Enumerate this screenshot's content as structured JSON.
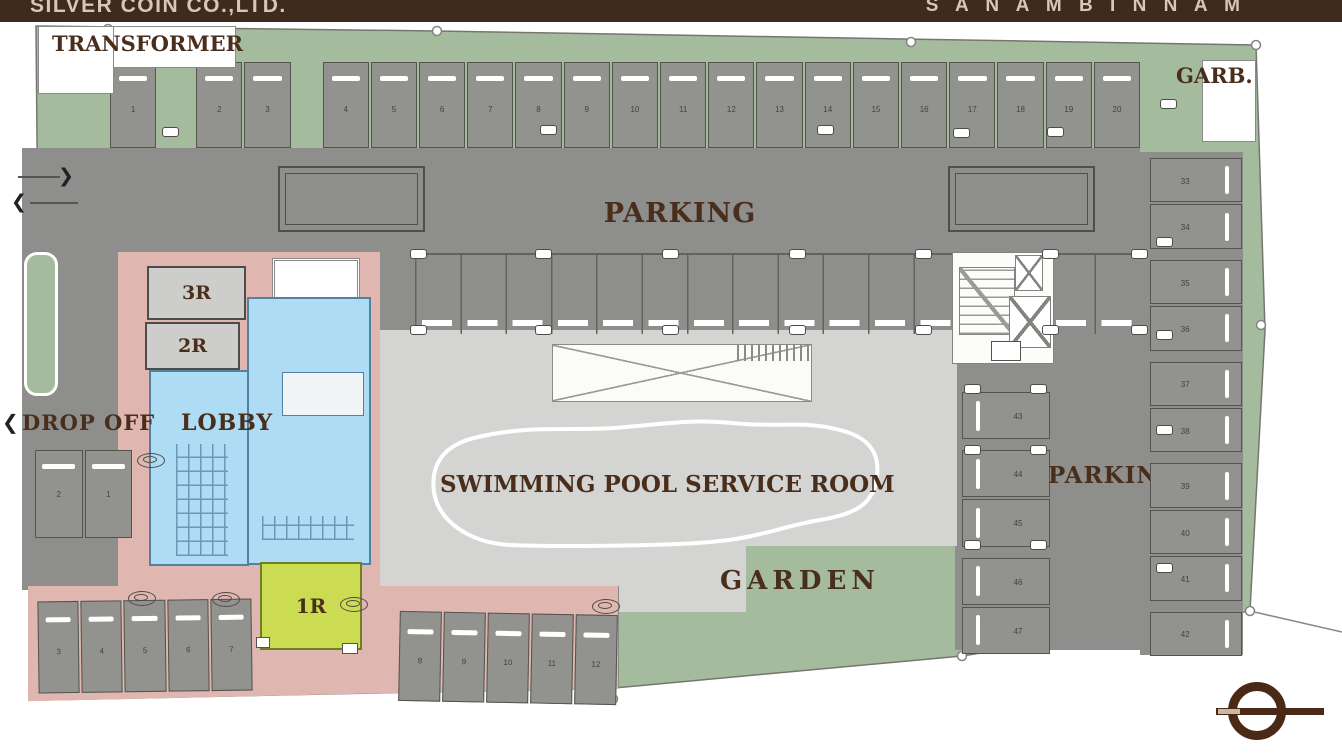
{
  "header": {
    "company": "SILVER COIN CO.,LTD.",
    "project": "S A N A M B I N N A M"
  },
  "labels": {
    "transformer": "TRANSFORMER",
    "garbage": "GARB.",
    "parking_center": "PARKING",
    "parking_right": "PARKING",
    "garden": "GARDEN",
    "pool_service": "SWIMMING POOL SERVICE ROOM",
    "drop_off": "DROP OFF",
    "lobby": "LOBBY",
    "room_3r": "3R",
    "room_2r": "2R",
    "room_1r": "1R"
  },
  "parking_stalls": {
    "top_row": [
      "1",
      "2",
      "3",
      "4",
      "5",
      "6",
      "7",
      "8",
      "9",
      "10",
      "11",
      "12",
      "13",
      "14",
      "15",
      "16",
      "17",
      "18",
      "19",
      "20"
    ],
    "right_column": [
      "33",
      "34",
      "35",
      "36",
      "37",
      "38",
      "39",
      "40",
      "41",
      "42"
    ],
    "inner_column": [
      "43",
      "44",
      "45",
      "46",
      "47"
    ],
    "bottom_left_row": [
      "3",
      "4",
      "5",
      "6",
      "7"
    ],
    "bottom_middle_row": [
      "8",
      "9",
      "10",
      "11",
      "12"
    ],
    "drop_off_stalls": [
      "2",
      "1"
    ]
  },
  "icons": {
    "arrow_left": "❮",
    "arrow_right": "❯"
  },
  "colors": {
    "banner_brown": "#3F2A1E",
    "site_green": "#A5BB9D",
    "paving_gray": "#8E8E8C",
    "slab_gray": "#D4D4D2",
    "driveway_pink": "#E0B6B0",
    "building_blue": "#AEDCF4",
    "room_lime": "#CBDC52",
    "label_brown": "#4A2E1C"
  }
}
